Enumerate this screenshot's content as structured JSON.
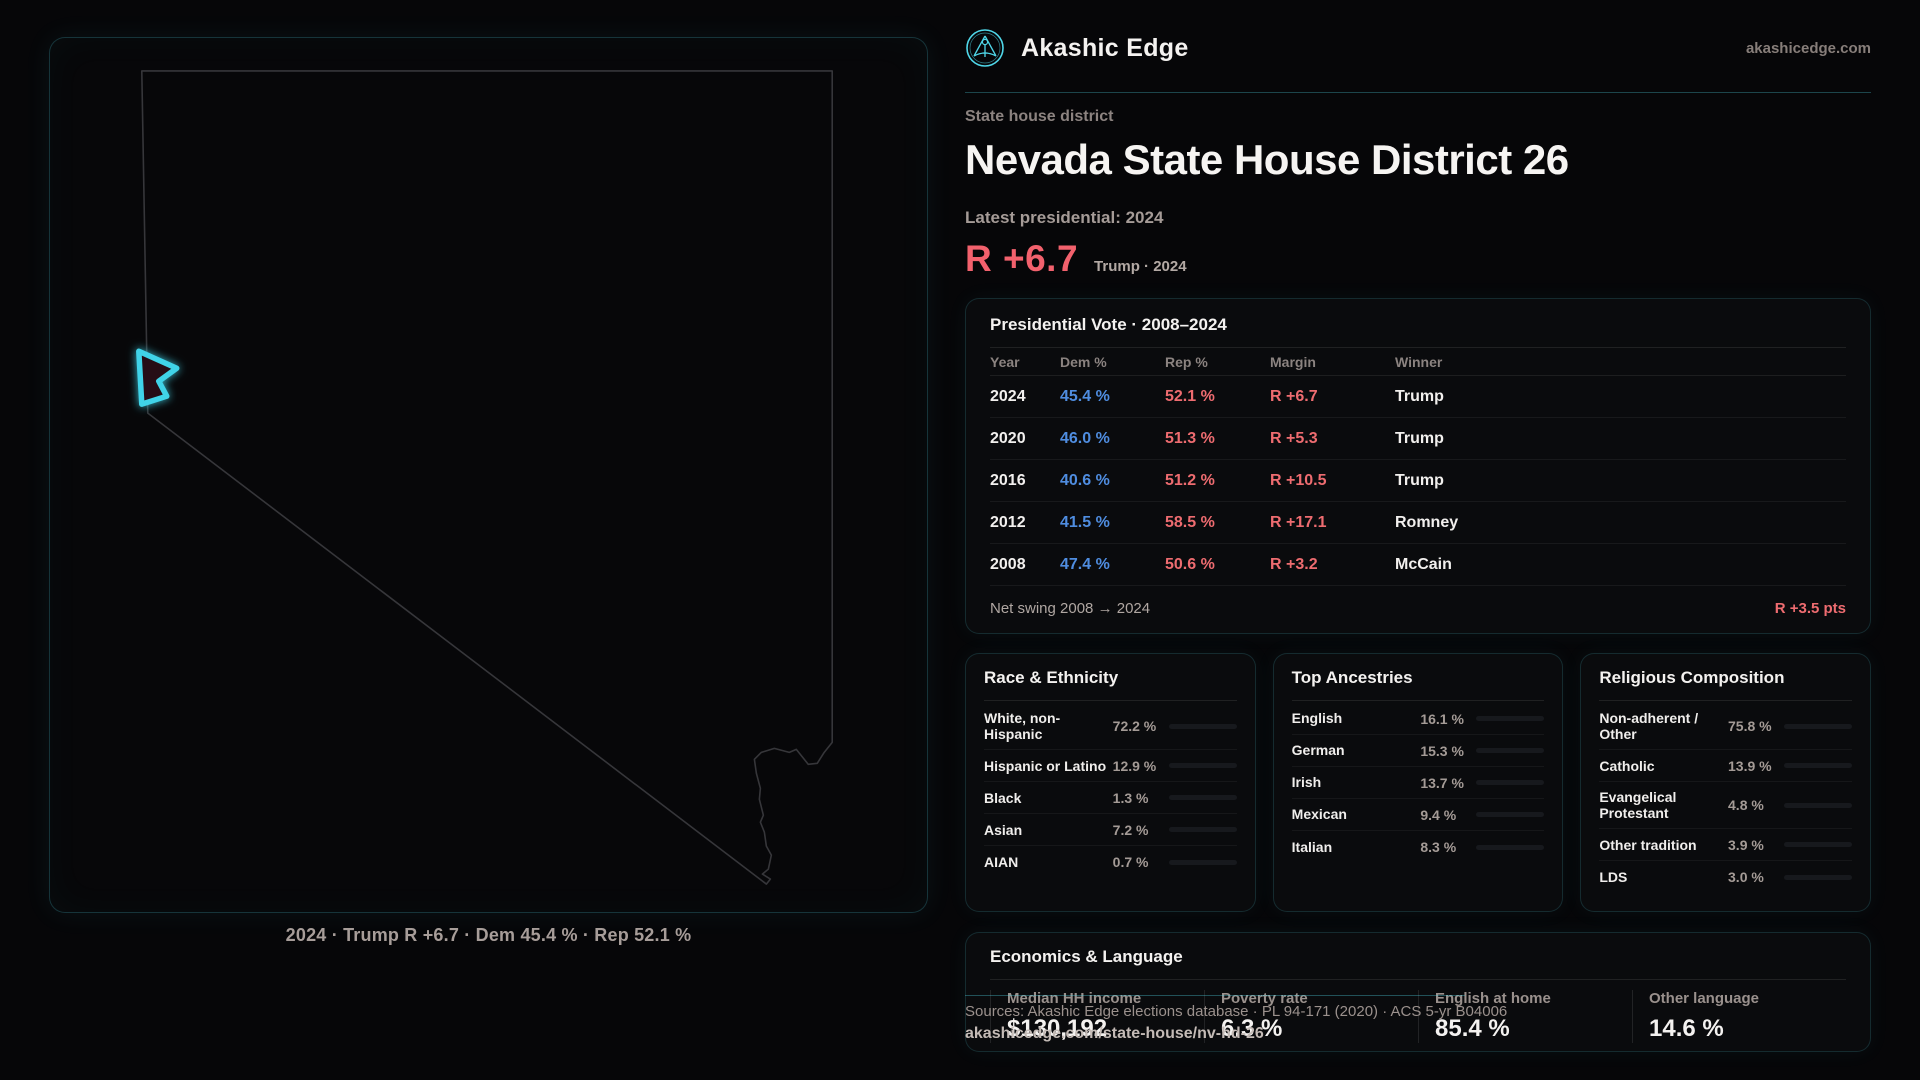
{
  "brand": {
    "name": "Akashic Edge",
    "domain": "akashicedge.com",
    "accent_color": "#4fd6e8"
  },
  "page": {
    "kicker": "State house district",
    "title": "Nevada State House District 26",
    "subtitle": "Latest presidential: 2024",
    "headline_margin": "R +6.7",
    "headline_context": "Trump · 2024",
    "margin_color": "#f2616d"
  },
  "map": {
    "caption": "2024 · Trump R +6.7 · Dem 45.4 % · Rep 52.1 %",
    "state": "Nevada",
    "district_color": "#3fd3e8",
    "outline_color": "#36363a"
  },
  "vote_table": {
    "title": "Presidential Vote · 2008–2024",
    "columns": [
      "Year",
      "Dem %",
      "Rep %",
      "Margin",
      "Winner"
    ],
    "rows": [
      {
        "year": "2024",
        "dem": "45.4 %",
        "rep": "52.1 %",
        "margin": "R +6.7",
        "winner": "Trump"
      },
      {
        "year": "2020",
        "dem": "46.0 %",
        "rep": "51.3 %",
        "margin": "R +5.3",
        "winner": "Trump"
      },
      {
        "year": "2016",
        "dem": "40.6 %",
        "rep": "51.2 %",
        "margin": "R +10.5",
        "winner": "Trump"
      },
      {
        "year": "2012",
        "dem": "41.5 %",
        "rep": "58.5 %",
        "margin": "R +17.1",
        "winner": "Romney"
      },
      {
        "year": "2008",
        "dem": "47.4 %",
        "rep": "50.6 %",
        "margin": "R +3.2",
        "winner": "McCain"
      }
    ],
    "net_swing_label": "Net swing 2008 → 2024",
    "net_swing_value": "R +3.5 pts",
    "dem_color": "#4f8de0",
    "rep_color": "#ee6c70"
  },
  "race": {
    "title": "Race & Ethnicity",
    "rows": [
      {
        "label": "White, non-Hispanic",
        "value": "72.2 %",
        "pct": 72.2,
        "color": "#93a9c6"
      },
      {
        "label": "Hispanic or Latino",
        "value": "12.9 %",
        "pct": 12.9,
        "color": "#e3a23c"
      },
      {
        "label": "Black",
        "value": "1.3 %",
        "pct": 1.3,
        "color": "#8678e8"
      },
      {
        "label": "Asian",
        "value": "7.2 %",
        "pct": 7.2,
        "color": "#34c08b"
      },
      {
        "label": "AIAN",
        "value": "0.7 %",
        "pct": 0.7,
        "color": "#d4763b"
      }
    ]
  },
  "ancestries": {
    "title": "Top Ancestries",
    "rows": [
      {
        "label": "English",
        "value": "16.1 %",
        "pct": 16.1,
        "color": "#9db3cc"
      },
      {
        "label": "German",
        "value": "15.3 %",
        "pct": 15.3,
        "color": "#9db3cc"
      },
      {
        "label": "Irish",
        "value": "13.7 %",
        "pct": 13.7,
        "color": "#9db3cc"
      },
      {
        "label": "Mexican",
        "value": "9.4 %",
        "pct": 9.4,
        "color": "#e3a23c"
      },
      {
        "label": "Italian",
        "value": "8.3 %",
        "pct": 8.3,
        "color": "#9db3cc"
      }
    ]
  },
  "religion": {
    "title": "Religious Composition",
    "rows": [
      {
        "label": "Non-adherent / Other",
        "value": "75.8 %",
        "pct": 75.8,
        "color": "#79828f"
      },
      {
        "label": "Catholic",
        "value": "13.9 %",
        "pct": 13.9,
        "color": "#e0b23e"
      },
      {
        "label": "Evangelical Protestant",
        "value": "4.8 %",
        "pct": 4.8,
        "color": "#e05f63"
      },
      {
        "label": "Other tradition",
        "value": "3.9 %",
        "pct": 3.9,
        "color": "#8a939c"
      },
      {
        "label": "LDS",
        "value": "3.0 %",
        "pct": 3.0,
        "color": "#2ec4ae"
      }
    ]
  },
  "economics": {
    "title": "Economics & Language",
    "stats": [
      {
        "label": "Median HH income",
        "value": "$130,192"
      },
      {
        "label": "Poverty rate",
        "value": "6.3 %"
      },
      {
        "label": "English at home",
        "value": "85.4 %"
      },
      {
        "label": "Other language",
        "value": "14.6 %"
      }
    ]
  },
  "footer": {
    "sources": "Sources: Akashic Edge elections database · PL 94-171 (2020) · ACS 5-yr B04006",
    "link": "akashicedge.com/state-house/nv-hd-26"
  }
}
